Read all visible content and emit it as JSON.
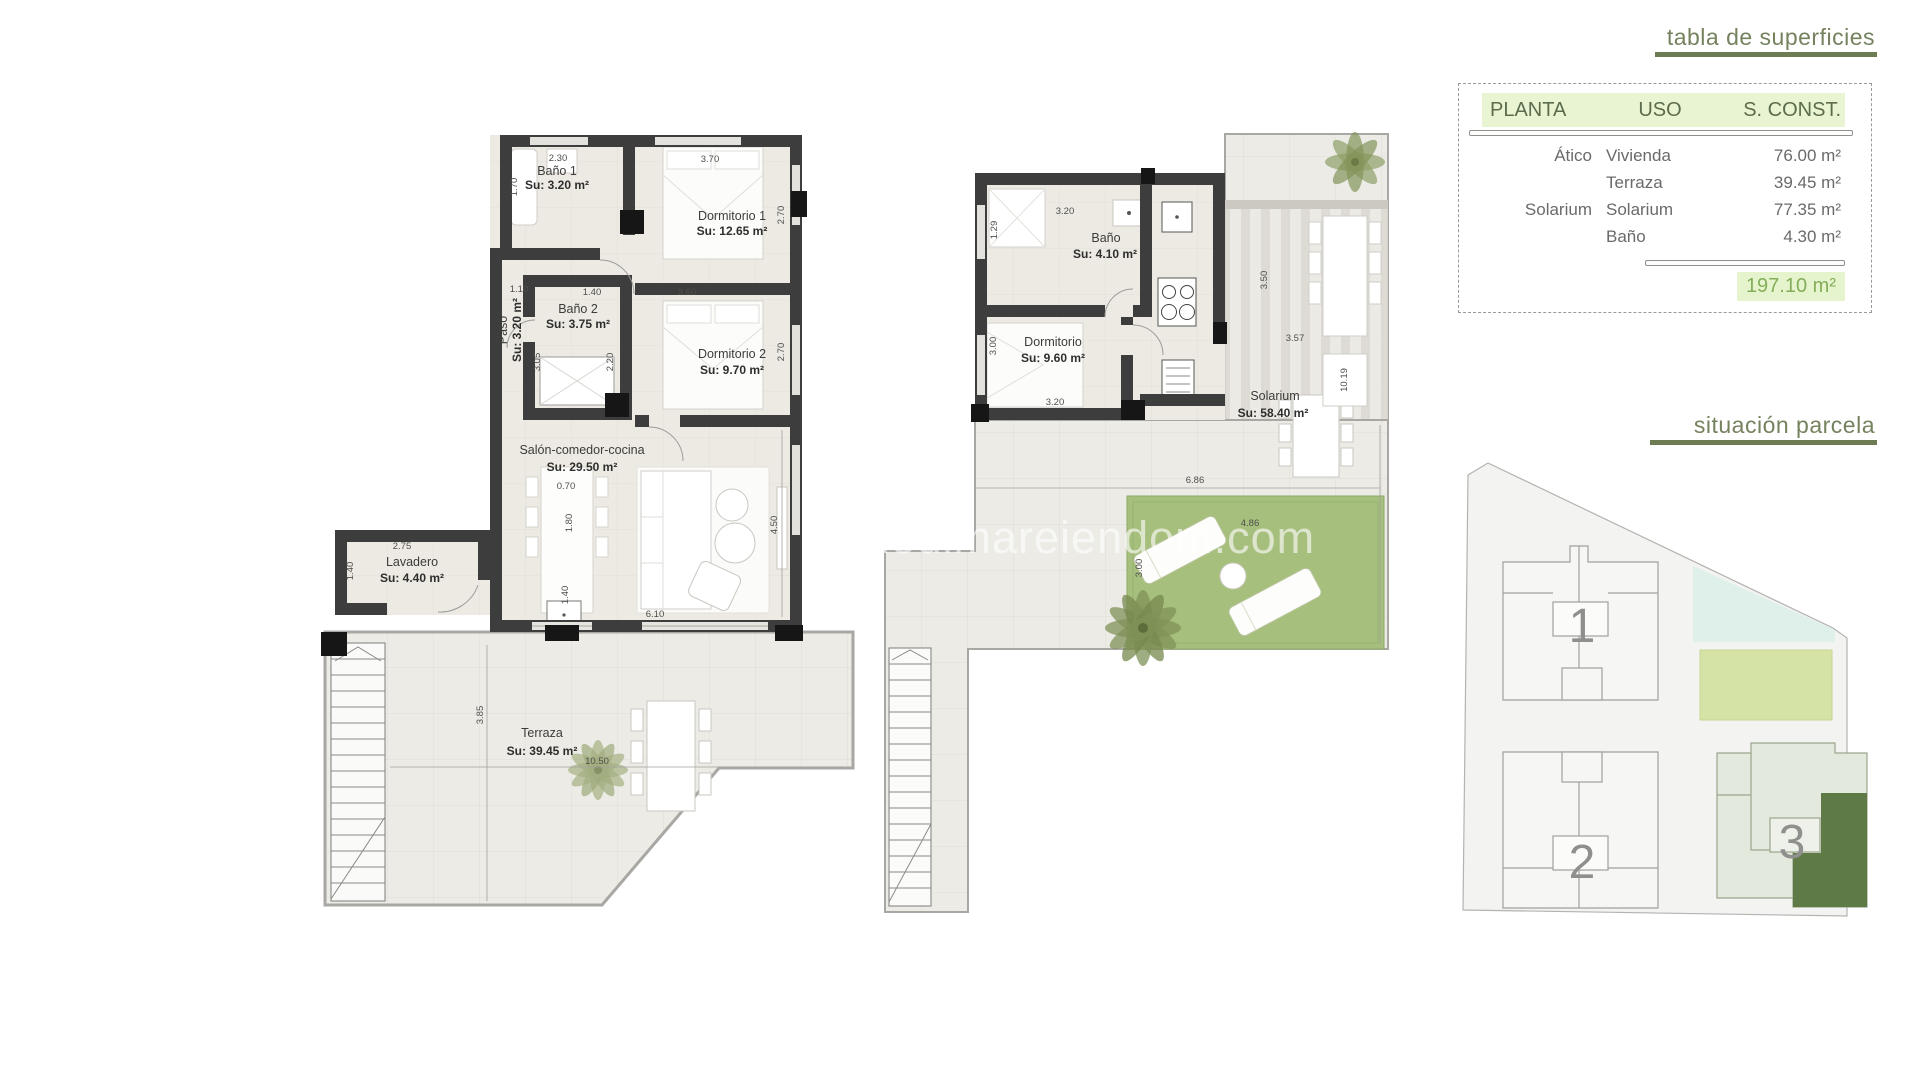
{
  "watermark": "medimareiendom.com",
  "surface_table": {
    "title": "tabla de superficies",
    "header": {
      "planta": "PLANTA",
      "uso": "USO",
      "sconst": "S. CONST."
    },
    "rows": [
      {
        "planta": "Ático",
        "uso": "Vivienda",
        "sconst": "76.00 m²"
      },
      {
        "planta": "",
        "uso": "Terraza",
        "sconst": "39.45 m²"
      },
      {
        "planta": "Solarium",
        "uso": "Solarium",
        "sconst": "77.35 m²"
      },
      {
        "planta": "",
        "uso": "Baño",
        "sconst": "4.30 m²"
      }
    ],
    "total": "197.10 m²"
  },
  "parcel": {
    "title": "situación parcela",
    "building1": "1",
    "building2": "2",
    "building3": "3"
  },
  "atico": {
    "bano1": {
      "name": "Baño 1",
      "area": "Su: 3.20 m²",
      "w": "2.30",
      "h": "1.70"
    },
    "dorm1": {
      "name": "Dormitorio 1",
      "area": "Su: 12.65 m²",
      "w": "3.70",
      "h": "2.70"
    },
    "paso": {
      "name": "Paso",
      "area": "Su: 3.20 m²",
      "w": "1.10",
      "h": "3.05"
    },
    "bano2": {
      "name": "Baño 2",
      "area": "Su: 3.75 m²",
      "w": "1.40",
      "h": "2.20"
    },
    "dorm2": {
      "name": "Dormitorio 2",
      "area": "Su: 9.70 m²",
      "w": "3.60",
      "h": "2.70"
    },
    "salon": {
      "name": "Salón-comedor-cocina",
      "area": "Su: 29.50 m²",
      "w": "6.10",
      "h": "4.50",
      "island_w": "0.70",
      "island_h": "1.80",
      "island_h2": "1.40"
    },
    "lavadero": {
      "name": "Lavadero",
      "area": "Su: 4.40 m²",
      "w": "2.75",
      "h": "1.40"
    },
    "terraza": {
      "name": "Terraza",
      "area": "Su: 39.45 m²",
      "w": "10.50",
      "h": "3.85"
    }
  },
  "solarium": {
    "bano": {
      "name": "Baño",
      "area": "Su: 4.10 m²",
      "w": "3.20",
      "h": "1.29"
    },
    "dorm": {
      "name": "Dormitorio",
      "area": "Su: 9.60 m²",
      "w": "3.20",
      "h": "3.00"
    },
    "main": {
      "name": "Solarium",
      "area": "Su: 58.40 m²",
      "w": "6.86",
      "h": "10.19"
    },
    "pergola": {
      "h": "3.50",
      "w": "3.57"
    },
    "lawn": {
      "w": "4.86",
      "h": "3.00"
    }
  },
  "colors": {
    "accent_green": "#6d7c52",
    "table_header_bg": "#e9f5d2",
    "total_green": "#84ae5a",
    "wall": "#3d3d3d",
    "lawn": "#a6bf7c",
    "parcel_highlight": "#5e7a46"
  }
}
